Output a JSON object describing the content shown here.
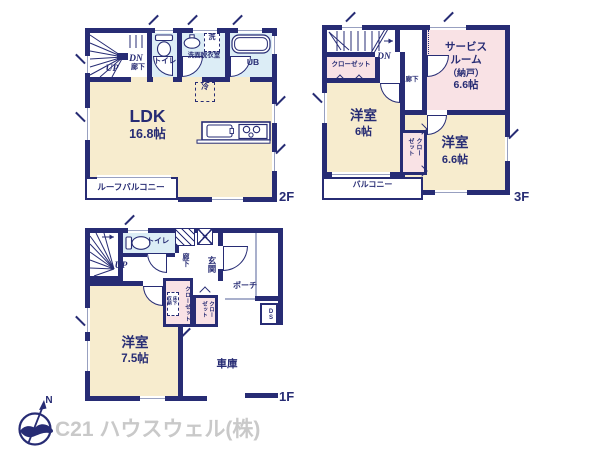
{
  "page": {
    "company": "C21 ハウスウェル(株)",
    "compass_north": "N"
  },
  "floor2": {
    "floor_label": "2F",
    "up": "UP",
    "dn": "DN",
    "hallway": "廊下",
    "toilet": "トイレ",
    "washroom": "洗面脱衣室",
    "washer": "洗",
    "unit_bath": "UB",
    "fridge": "冷",
    "ldk_name": "LDK",
    "ldk_size": "16.8帖",
    "roof_balcony": "ルーフバルコニー"
  },
  "floor3": {
    "floor_label": "3F",
    "dn": "DN",
    "closet_north": "クローゼット",
    "hallway": "廊下",
    "service_room_line1": "サービス",
    "service_room_line2": "ルーム",
    "service_room_line3": "（納戸）",
    "service_room_size": "6.6帖",
    "west_room_name": "洋室",
    "west_room_size": "6帖",
    "east_room_name": "洋室",
    "east_room_size": "6.6帖",
    "closet_middle": "クローゼット",
    "balcony": "バルコニー"
  },
  "floor1": {
    "floor_label": "1F",
    "up": "UP",
    "toilet": "トイレ",
    "hallway": "廊下",
    "entrance": "玄関",
    "porch": "ポーチ",
    "closet_a": "クローゼット",
    "underfloor_storage": "床下収納",
    "closet_b": "クローゼット",
    "duct_space": "DS",
    "room_name": "洋室",
    "room_size": "7.5帖",
    "garage": "車庫"
  },
  "colors": {
    "wall": "#272c74",
    "room_cream": "#f7ecce",
    "room_pink": "#f9e2e5",
    "room_blue": "#dcedf6",
    "company_text": "#c9c9c9"
  }
}
